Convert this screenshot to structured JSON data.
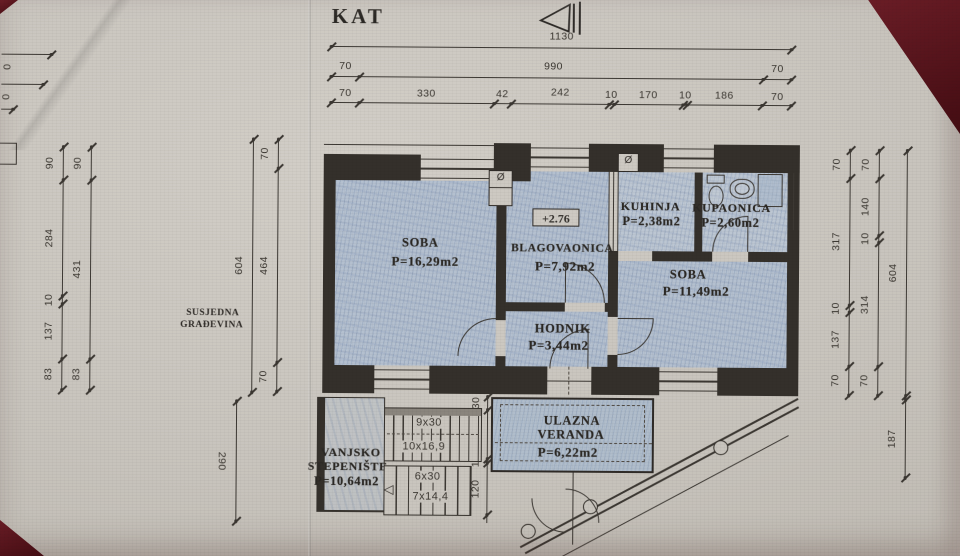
{
  "title": "KAT",
  "scan": {
    "paper": "#c8c4bd",
    "table": "#4e1016",
    "ink": "#2e2b28",
    "pencil_blue": "#b4c0cf"
  },
  "top_dims": {
    "total": "1130",
    "mid": [
      "70",
      "990",
      "70"
    ],
    "detail": [
      "70",
      "330",
      "42",
      "242",
      "10",
      "170",
      "10",
      "186",
      "70"
    ]
  },
  "left_dims": {
    "outer": [
      "90",
      "284",
      "10",
      "137",
      "83"
    ],
    "inner": [
      "90",
      "431",
      "83"
    ],
    "wall": [
      "70",
      "464",
      "70"
    ],
    "total": "604",
    "below": "290",
    "fragment": [
      "0",
      "0"
    ]
  },
  "right_dims": {
    "inner": [
      "70",
      "317",
      "10",
      "137",
      "70"
    ],
    "mid": [
      "70",
      "140",
      "10",
      "314",
      "70"
    ],
    "total": "604",
    "below": "187"
  },
  "stair_dims": [
    "30",
    "120",
    "10",
    "120"
  ],
  "neighbor": {
    "line1": "SUSJEDNA",
    "line2": "GRAĐEVINA"
  },
  "elevation": "+2.76",
  "chimney_symbol": "Ø",
  "rooms": {
    "soba1": {
      "name": "SOBA",
      "area": "P=16,29m2"
    },
    "blagovaonica": {
      "name": "BLAGOVAONICA",
      "area": "P=7,92m2"
    },
    "kuhinja": {
      "name": "KUHINJA",
      "area": "P=2,38m2"
    },
    "kupaonica": {
      "name": "KUPAONICA",
      "area": "P=2,60m2"
    },
    "soba2": {
      "name": "SOBA",
      "area": "P=11,49m2"
    },
    "hodnik": {
      "name": "HODNIK",
      "area": "P=3,44m2"
    },
    "veranda": {
      "name1": "ULAZNA",
      "name2": "VERANDA",
      "area": "P=6,22m2"
    },
    "stepeniste": {
      "name1": "VANJSKO",
      "name2": "STEPENIŠTE",
      "area": "P=10,64m2"
    }
  },
  "stairs": {
    "upper_run": "9x30",
    "upper_riser": "10x16,9",
    "lower_run": "6x30",
    "lower_riser": "7x14,4"
  }
}
